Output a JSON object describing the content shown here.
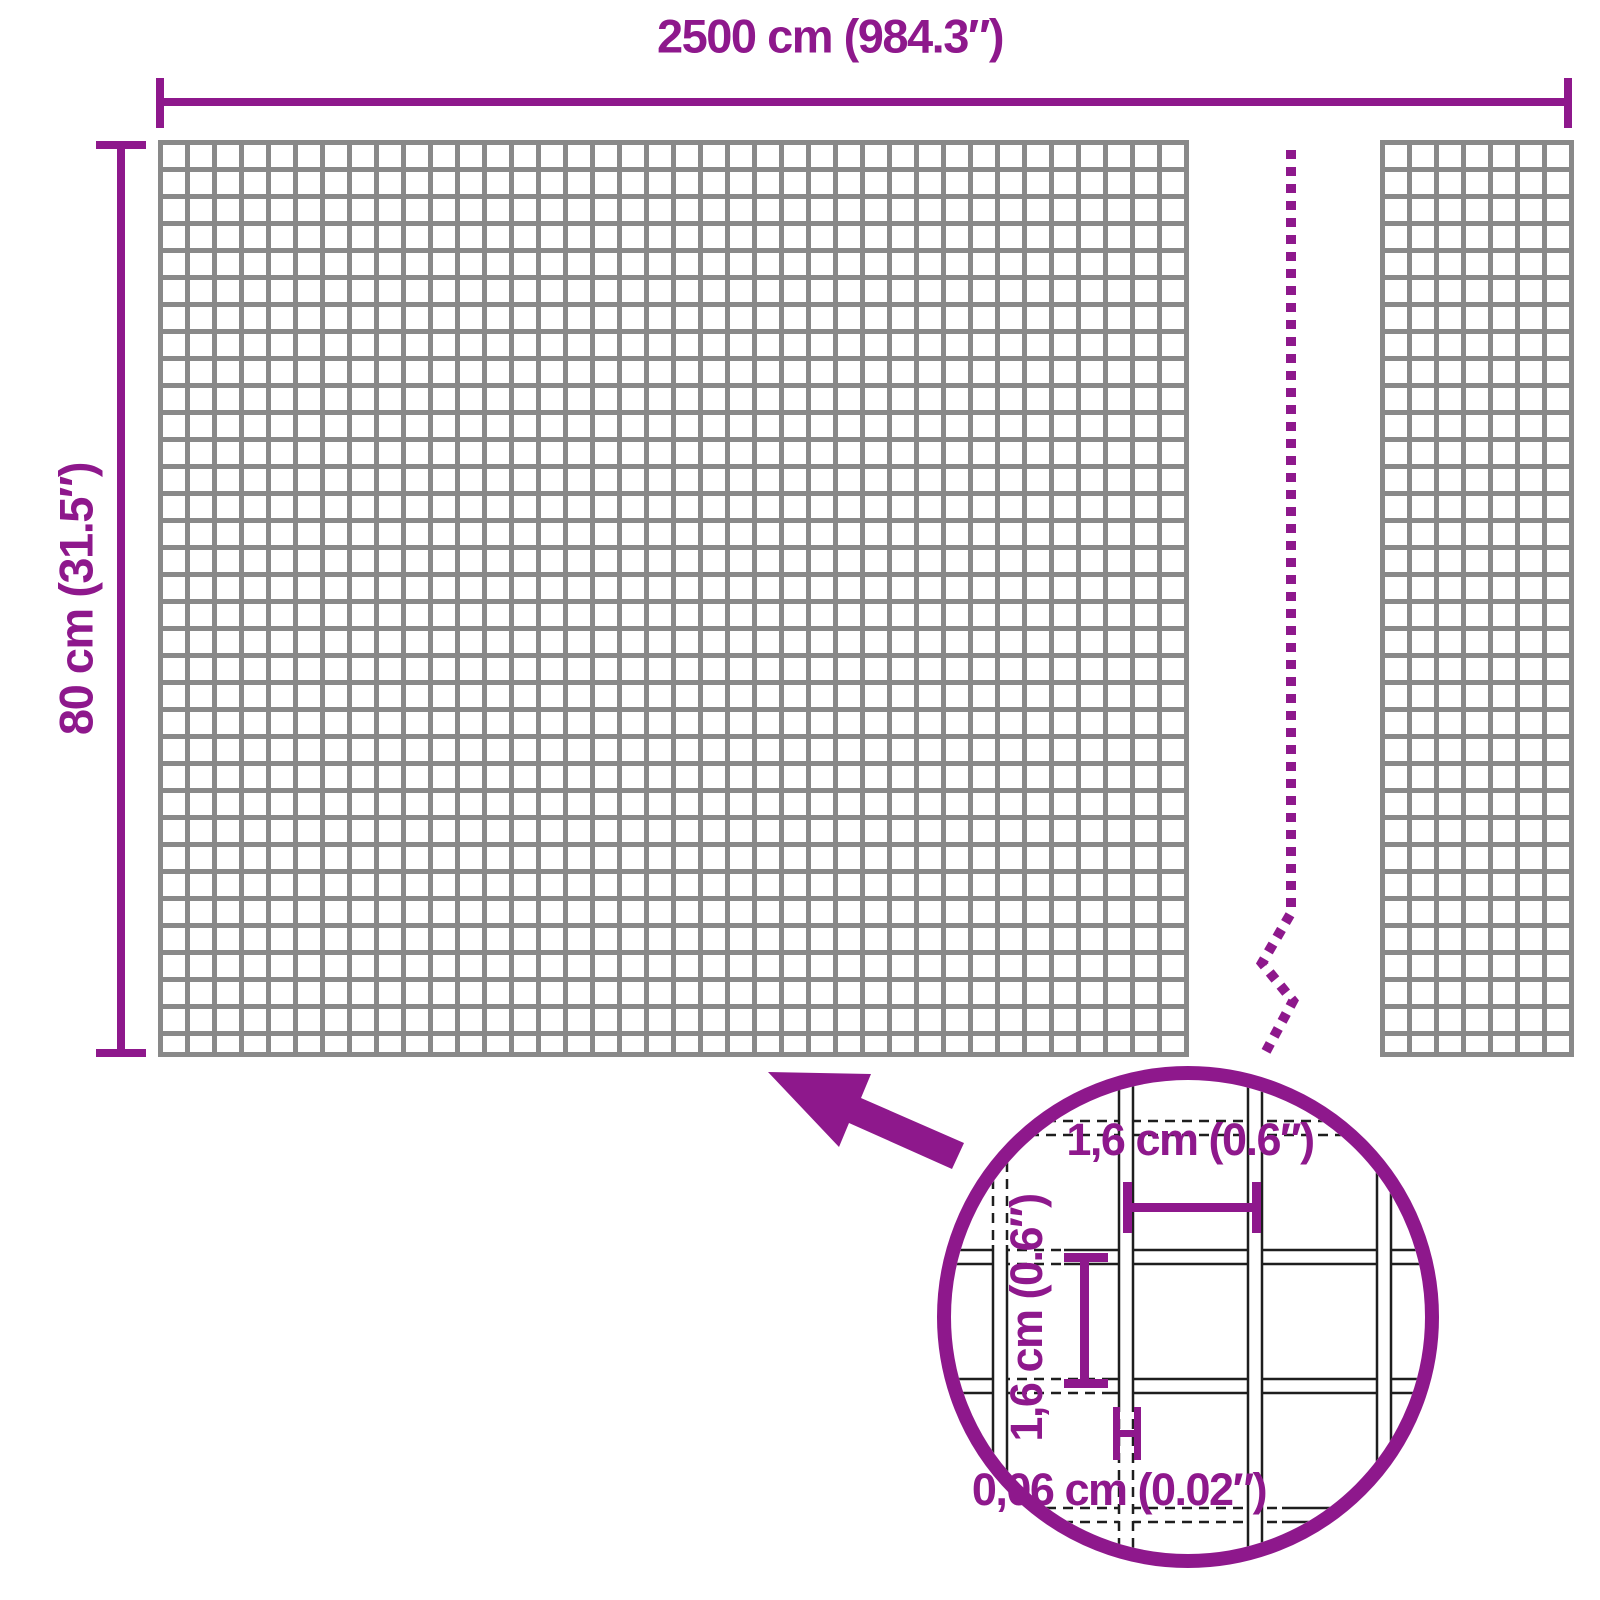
{
  "diagram": {
    "total_width_label": "2500 cm (984.3″)",
    "total_height_label": "80 cm (31.5″)",
    "detail": {
      "opening_width_label": "1,6 cm (0.6″)",
      "opening_height_label": "1,6 cm (0.6″)",
      "wire_thickness_label": "0,06 cm (0.02″)"
    }
  },
  "colors": {
    "accent": "#8E188C",
    "grid": "#898989",
    "wire": "#1E1E1E",
    "background": "#FFFFFF"
  }
}
